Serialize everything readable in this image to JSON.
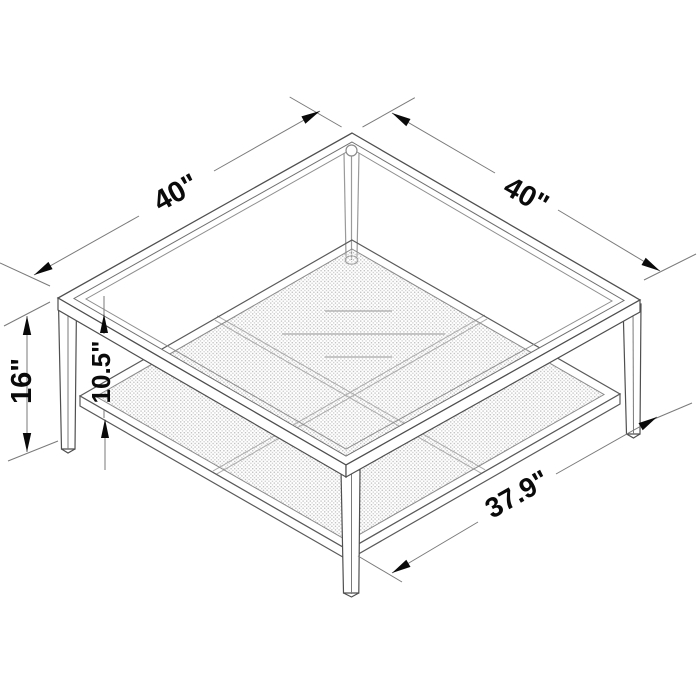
{
  "figure": {
    "description": "isometric-line-drawing-of-square-coffee-table-with-glass-top-and-mesh-shelf",
    "background_color": "#ffffff",
    "outline_color": "#4f4f4f",
    "mesh_color": "#c6c6c6",
    "dimension_color": "#0a0a0a",
    "dimensions": {
      "top_left_edge": "40\"",
      "top_right_edge": "40\"",
      "overall_height": "16\"",
      "shelf_clearance": "10.5\"",
      "shelf_bottom_edge": "37.9\""
    }
  }
}
